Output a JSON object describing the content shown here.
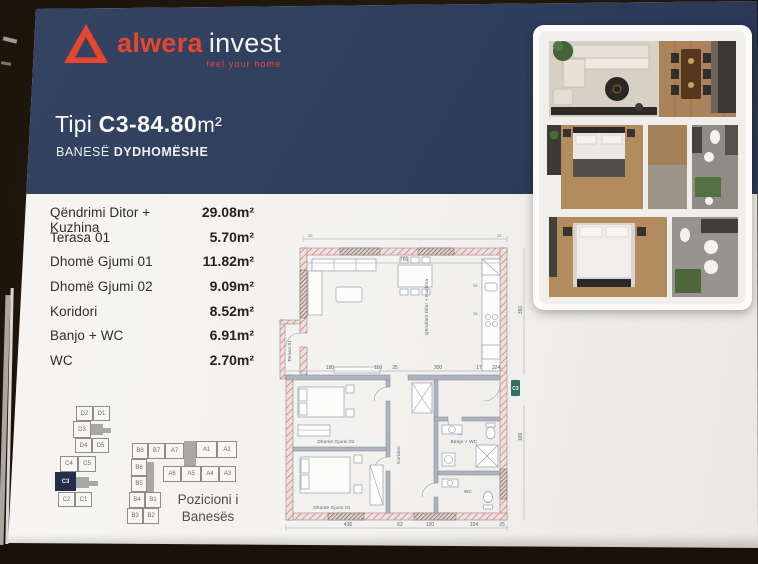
{
  "brand": {
    "logo_word_primary": "alwera",
    "logo_word_secondary": "invest",
    "tagline": "feel your home",
    "accent_color": "#e8452f",
    "navy_color": "#2e3e5c"
  },
  "header": {
    "title_prefix": "Tipi",
    "title_code": "C3-84.80",
    "title_unit": "m²",
    "subtitle_light": "BANESË",
    "subtitle_bold": "DYDHOMËSHE"
  },
  "room_list": {
    "rooms": [
      {
        "label": "Qëndrimi Ditor + Kuzhina",
        "area": "29.08m²"
      },
      {
        "label": "Terasa 01",
        "area": "5.70m²"
      },
      {
        "label": "Dhomë Gjumi 01",
        "area": "11.82m²"
      },
      {
        "label": "Dhomë Gjumi 02",
        "area": "9.09m²"
      },
      {
        "label": "Koridori",
        "area": "8.52m²"
      },
      {
        "label": "Banjo + WC",
        "area": "6.91m²"
      },
      {
        "label": "WC",
        "area": "2.70m²"
      }
    ]
  },
  "position_diagram": {
    "caption_line1": "Pozicioni i",
    "caption_line2": "Banesës",
    "highlighted_unit": "C3",
    "highlight_color": "#252e48",
    "building_cd_cells": [
      "D2",
      "D1",
      "D3",
      "D4",
      "D5",
      "C4",
      "C5",
      "C3",
      "C2",
      "C1"
    ],
    "building_ab_cells": [
      "B8",
      "B7",
      "A7",
      "A1",
      "A2",
      "A6",
      "A5",
      "A4",
      "A3",
      "B6",
      "B5",
      "B4",
      "B1",
      "B3",
      "B2"
    ]
  },
  "floorplan": {
    "entrance_badge": "C3",
    "entrance_badge_color": "#2f7060",
    "labels": {
      "living": "Qëndrimi Ditor + Kuzhina",
      "terrace": "Terasa 01",
      "bedroom1": "Dhomë Gjumi 01",
      "bedroom2": "Dhomë Gjumi 02",
      "corridor": "Koridori",
      "bath": "Banjo + WC",
      "wc": "WC"
    },
    "dimensions": {
      "top_width": "766",
      "right_height": "390",
      "entry_side": "169",
      "corner_left": "25",
      "corner_right": "25",
      "kitchen_1": "25",
      "kitchen_2": "25",
      "mid_row": [
        "180",
        "110",
        "25",
        "300",
        "17",
        "324"
      ],
      "bottom_row": [
        "436",
        "62",
        "130",
        "104",
        "25"
      ]
    }
  }
}
